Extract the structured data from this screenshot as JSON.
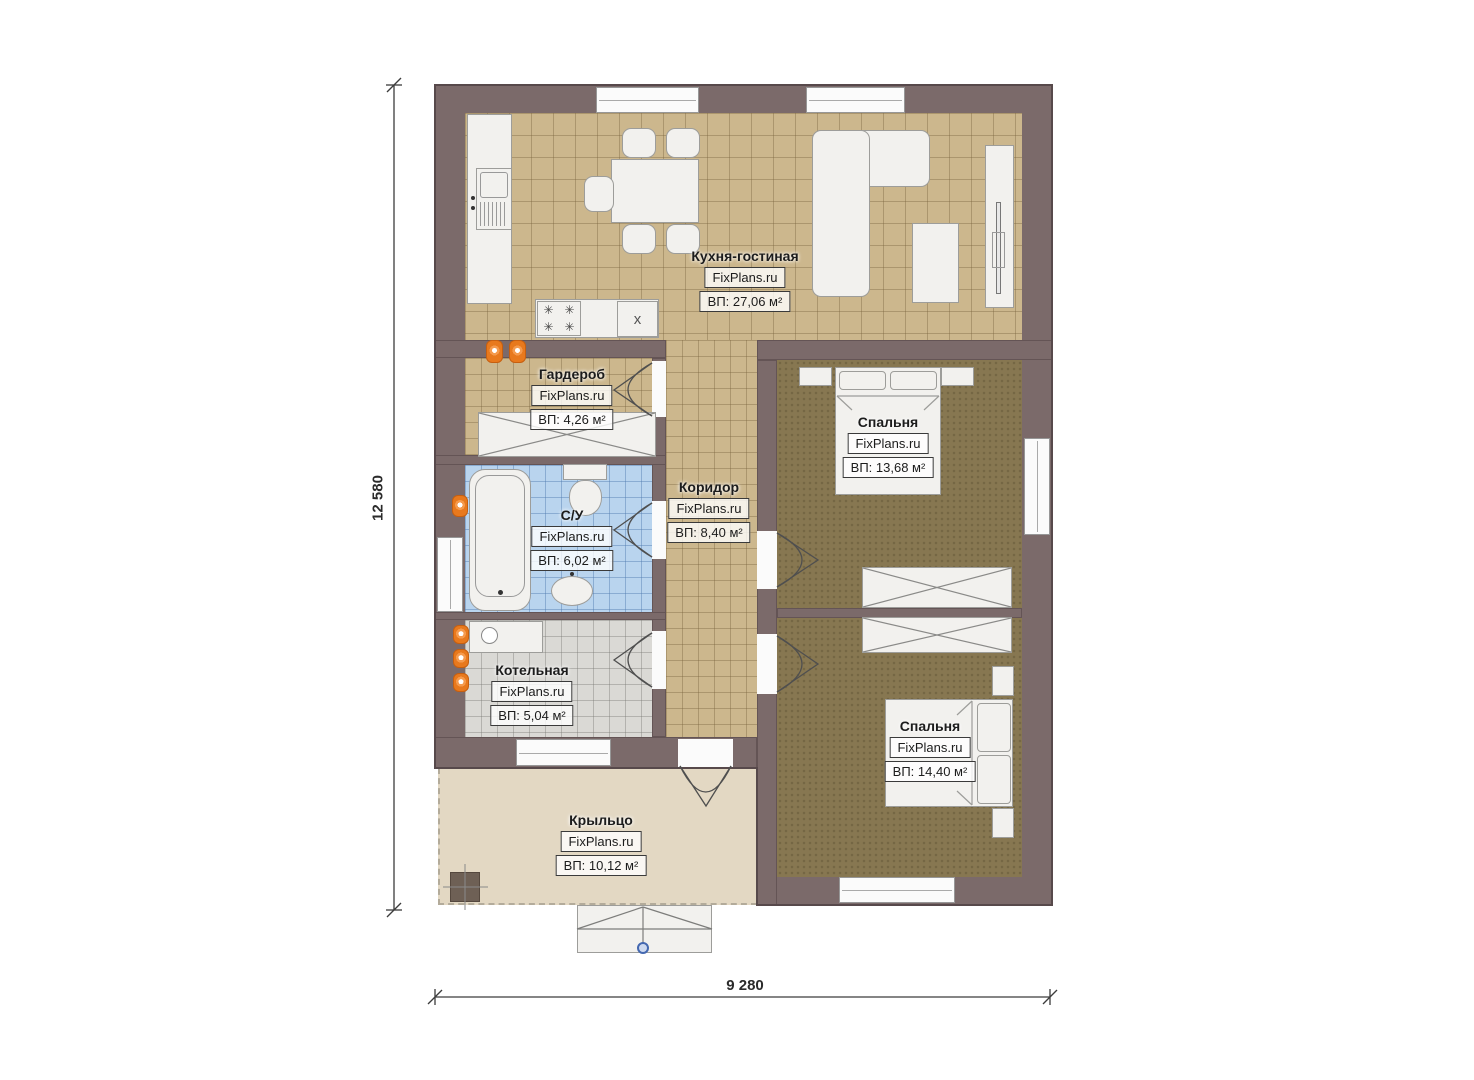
{
  "plan": {
    "brand": "FixPlans.ru",
    "rooms": {
      "kitchen_living": {
        "name": "Кухня-гостиная",
        "site": "FixPlans.ru",
        "area": "ВП: 27,06 м²"
      },
      "wardrobe": {
        "name": "Гардероб",
        "site": "FixPlans.ru",
        "area": "ВП: 4,26 м²"
      },
      "bathroom": {
        "name": "С/У",
        "site": "FixPlans.ru",
        "area": "ВП: 6,02 м²"
      },
      "corridor": {
        "name": "Коридор",
        "site": "FixPlans.ru",
        "area": "ВП: 8,40 м²"
      },
      "boiler_room": {
        "name": "Котельная",
        "site": "FixPlans.ru",
        "area": "ВП: 5,04 м²"
      },
      "bedroom_1": {
        "name": "Спальня",
        "site": "FixPlans.ru",
        "area": "ВП: 13,68 м²"
      },
      "bedroom_2": {
        "name": "Спальня",
        "site": "FixPlans.ru",
        "area": "ВП: 14,40 м²"
      },
      "porch": {
        "name": "Крыльцо",
        "site": "FixPlans.ru",
        "area": "ВП: 10,12 м²"
      }
    },
    "dimensions": {
      "vertical": "12 580",
      "horizontal": "9 280"
    },
    "icons": {
      "appliance_x": "x",
      "stove_burner": "✳"
    },
    "colors": {
      "wall": "#7b6a6a",
      "tile_floor": "#ccb78d",
      "bedroom_floor": "#877751",
      "bathroom_floor": "#b9d4ee",
      "boiler_floor": "#dad9d5",
      "porch_floor": "#e3d8c3",
      "radiator": "#e8791d",
      "entry_marker": "#4468b0"
    }
  }
}
